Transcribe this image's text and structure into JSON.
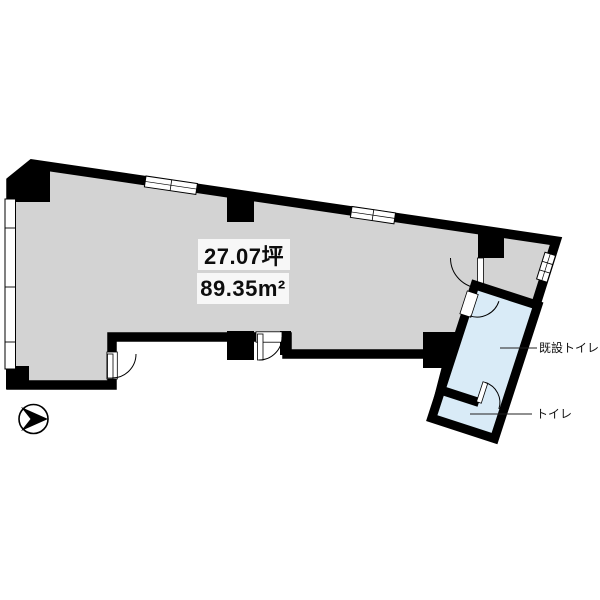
{
  "plan": {
    "area_labels": {
      "tsubo": "27.07坪",
      "square_meters": "89.35m²"
    },
    "room_labels": {
      "existing_toilet": "既設トイレ",
      "toilet": "トイレ"
    },
    "colors": {
      "floor": "#d3d3d3",
      "toilet_floor": "#d9ebf7",
      "walls": "#000000",
      "area_label_background": "#f7f7f7",
      "background": "#ffffff"
    },
    "icons": {
      "north_arrow": "compass-arrow"
    }
  }
}
